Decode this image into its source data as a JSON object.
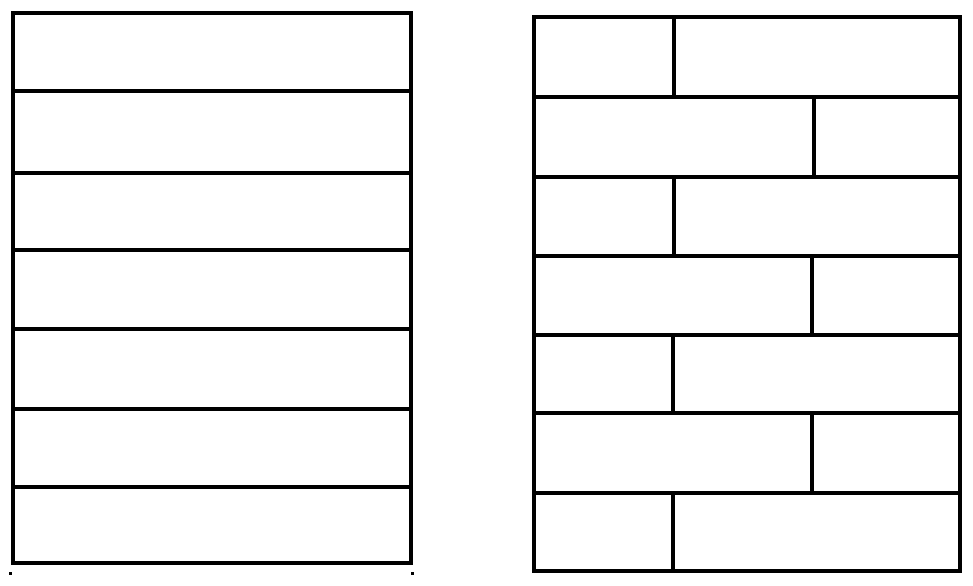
{
  "figure": {
    "background_color": "#ffffff",
    "line_color": "#000000",
    "line_width_px": 4,
    "panels": [
      {
        "id": "left-panel-aligned-planks",
        "x": 11,
        "y": 11,
        "width": 402,
        "height": 554,
        "rows": [
          {
            "height": 79,
            "joints": []
          },
          {
            "height": 82,
            "joints": []
          },
          {
            "height": 78,
            "joints": []
          },
          {
            "height": 79,
            "joints": []
          },
          {
            "height": 81,
            "joints": []
          },
          {
            "height": 79,
            "joints": []
          },
          {
            "height": 76,
            "joints": []
          }
        ]
      },
      {
        "id": "right-panel-staggered-planks",
        "x": 532,
        "y": 15,
        "width": 430,
        "height": 558,
        "rows": [
          {
            "height": 81,
            "joints": [
              140
            ]
          },
          {
            "height": 80,
            "joints": [
              284
            ]
          },
          {
            "height": 80,
            "joints": [
              140
            ]
          },
          {
            "height": 79,
            "joints": [
              282
            ]
          },
          {
            "height": 79,
            "joints": [
              139
            ]
          },
          {
            "height": 80,
            "joints": [
              282
            ]
          },
          {
            "height": 79,
            "joints": [
              139
            ]
          }
        ]
      }
    ],
    "artifact_dots": [
      {
        "x": 9,
        "y": 572,
        "size": 3
      },
      {
        "x": 411,
        "y": 572,
        "size": 3
      }
    ]
  }
}
